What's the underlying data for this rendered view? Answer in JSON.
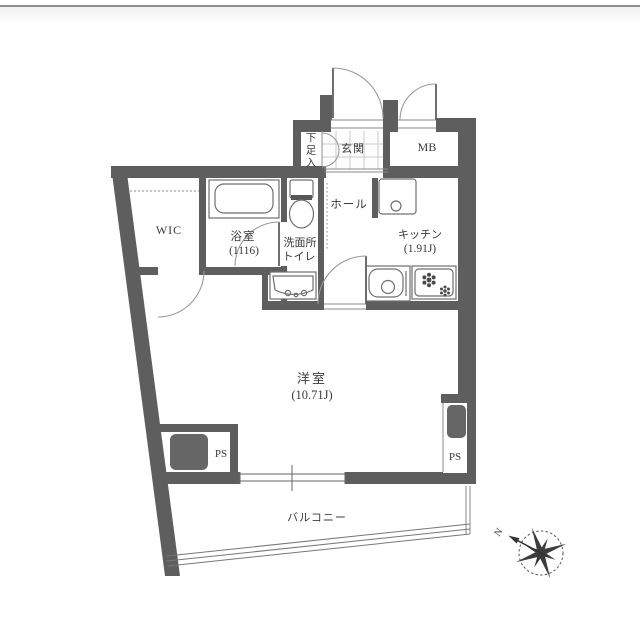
{
  "floorplan": {
    "rooms": {
      "wic": {
        "label": "WIC"
      },
      "bath": {
        "label": "浴室",
        "size": "(1116)"
      },
      "washroom_toilet": {
        "line1": "洗面所",
        "line2": "トイレ"
      },
      "shoe_box": {
        "label": "下足入"
      },
      "entrance": {
        "label": "玄関"
      },
      "meter_box": {
        "label": "MB"
      },
      "hall": {
        "label": "ホール"
      },
      "kitchen": {
        "label": "キッチン",
        "size": "(1.91J)"
      },
      "western_room": {
        "label": "洋室",
        "size": "(10.71J)"
      },
      "ps_left": {
        "label": "PS"
      },
      "ps_right": {
        "label": "PS"
      },
      "balcony": {
        "label": "バルコニー"
      }
    },
    "compass": {
      "north": "N"
    }
  },
  "colors": {
    "wall": "#5e5e5e",
    "door_line": "#8a8a8a",
    "fixture_line": "#6f6f6f",
    "text": "#3a3a3a",
    "tile_line": "#cccccc",
    "top_border": "#8f8f8f"
  }
}
